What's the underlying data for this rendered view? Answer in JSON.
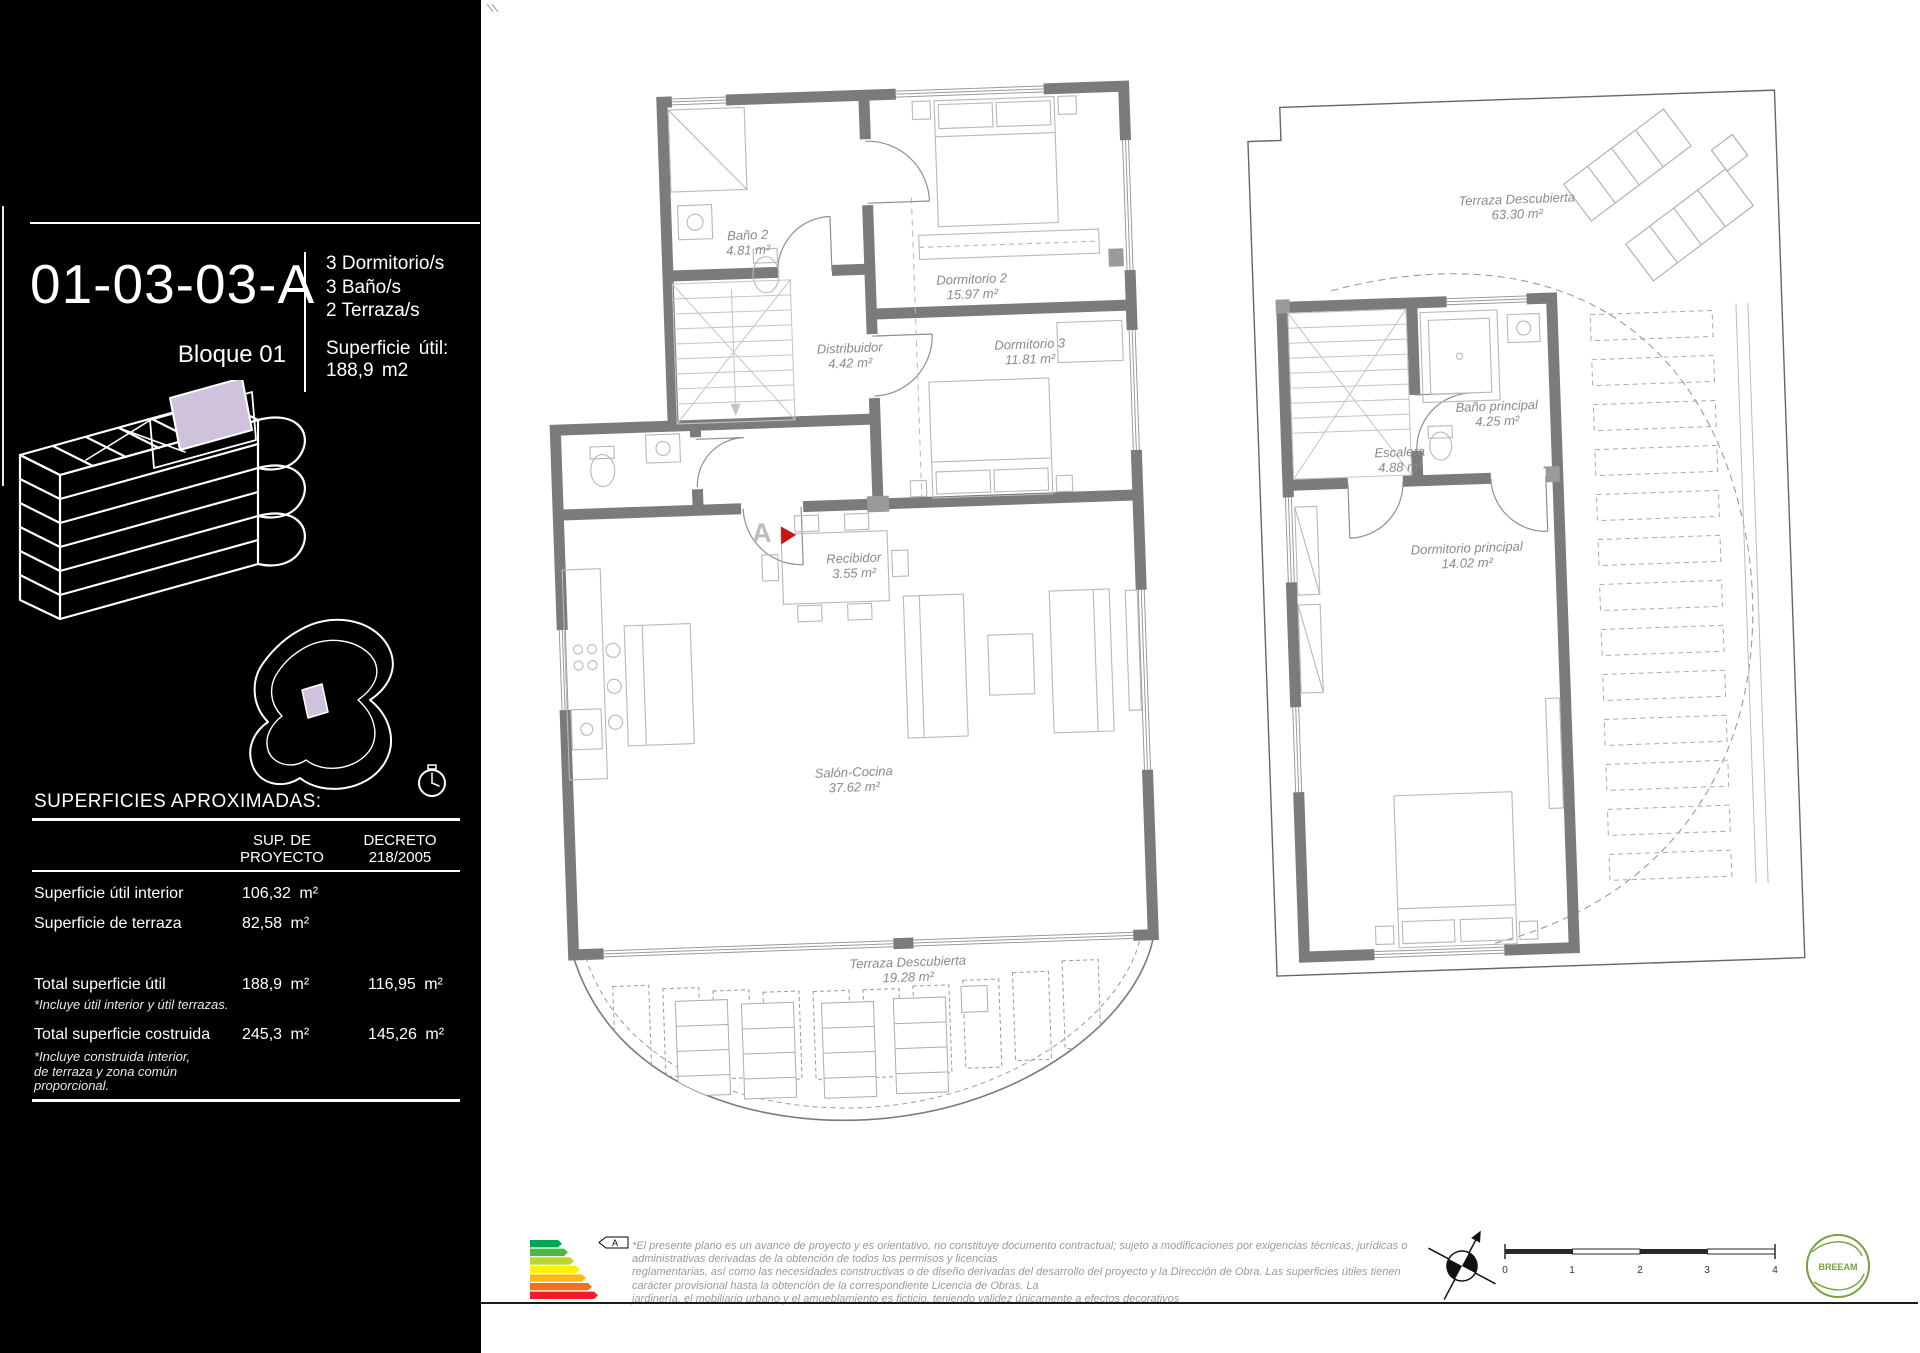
{
  "sidebar": {
    "unit_code": "01-03-03-A",
    "block_label": "Bloque 01",
    "specs": [
      "3 Dormitorio/s",
      "3 Baño/s",
      "2 Terraza/s"
    ],
    "superficie": {
      "label": "Superficie útil:",
      "value": "188,9 m2"
    },
    "table": {
      "title": "SUPERFICIES APROXIMADAS:",
      "columns": {
        "col1": [
          "SUP. DE",
          "PROYECTO"
        ],
        "col2": [
          "DECRETO",
          "218/2005"
        ]
      },
      "rows": [
        {
          "label": "Superficie útil interior",
          "proyecto": "106,32 m²",
          "decreto": ""
        },
        {
          "label": "Superficie de terraza",
          "proyecto": "82,58 m²",
          "decreto": ""
        },
        {
          "label": "Total superficie útil",
          "proyecto": "188,9 m²",
          "decreto": "116,95 m²",
          "note_lines": [
            "*Incluye útil interior y útil terrazas."
          ]
        },
        {
          "label": "Total superficie costruida",
          "proyecto": "245,3 m²",
          "decreto": "145,26 m²",
          "note_lines": [
            "*Incluye construida interior,",
            "de terraza y zona común",
            "proporcional."
          ]
        }
      ]
    }
  },
  "plans": {
    "plan1": {
      "entry_marker": "A",
      "rooms": [
        {
          "name": "Baño 2",
          "area": "4.81 m²",
          "x": 748,
          "y": 243
        },
        {
          "name": "Dormitorio 2",
          "area": "15.97 m²",
          "x": 972,
          "y": 287
        },
        {
          "name": "Dormitorio 3",
          "area": "11.81 m²",
          "x": 1030,
          "y": 352
        },
        {
          "name": "Distribuidor",
          "area": "4.42 m²",
          "x": 850,
          "y": 356
        },
        {
          "name": "Recibidor",
          "area": "3.55 m²",
          "x": 854,
          "y": 566
        },
        {
          "name": "Salón-Cocina",
          "area": "37.62 m²",
          "x": 854,
          "y": 780
        },
        {
          "name": "Terraza Descubierta",
          "area": "19.28 m²",
          "x": 908,
          "y": 970
        }
      ]
    },
    "plan2": {
      "rooms": [
        {
          "name": "Terraza Descubierta",
          "area": "63.30 m²",
          "x": 1517,
          "y": 207
        },
        {
          "name": "Escalera",
          "area": "4.88 m²",
          "x": 1400,
          "y": 460
        },
        {
          "name": "Baño principal",
          "area": "4.25 m²",
          "x": 1497,
          "y": 414
        },
        {
          "name": "Dormitorio principal",
          "area": "14.02 m²",
          "x": 1467,
          "y": 556
        }
      ]
    }
  },
  "footer": {
    "disclaimer_lines": [
      "*El presente plano es un avance de proyecto y es orientativo, no constituye documento contractual; sujeto a modificaciones por exigencias técnicas, jurídicas o",
      "administrativas derivadas de la obtención de todos los permisos y licencias",
      "reglamentarias, así como las necesidades constructivas o de diseño derivadas del desarrollo del proyecto y la Dirección de Obra. Las superficies útiles tienen",
      "carácter provisional hasta la obtención de la correspondiente Licencia de Obras. La",
      "jardinería, el mobiliario urbano y el amueblamiento es ficticio, teniendo validez únicamente a efectos decorativos"
    ],
    "scale_ticks": [
      "0",
      "1",
      "2",
      "3",
      "4"
    ],
    "energy_label_letter": "A",
    "energy_colors": [
      "#00a650",
      "#4db848",
      "#bed62f",
      "#fff200",
      "#fcb814",
      "#f36f21",
      "#ee1c25"
    ],
    "breeam_label": "BREEAM"
  },
  "colors": {
    "accent_lavender": "#cfc2dd",
    "wall_gray": "#7b7b7b",
    "marker_red": "#c81616",
    "breeam_green": "#76a240"
  }
}
